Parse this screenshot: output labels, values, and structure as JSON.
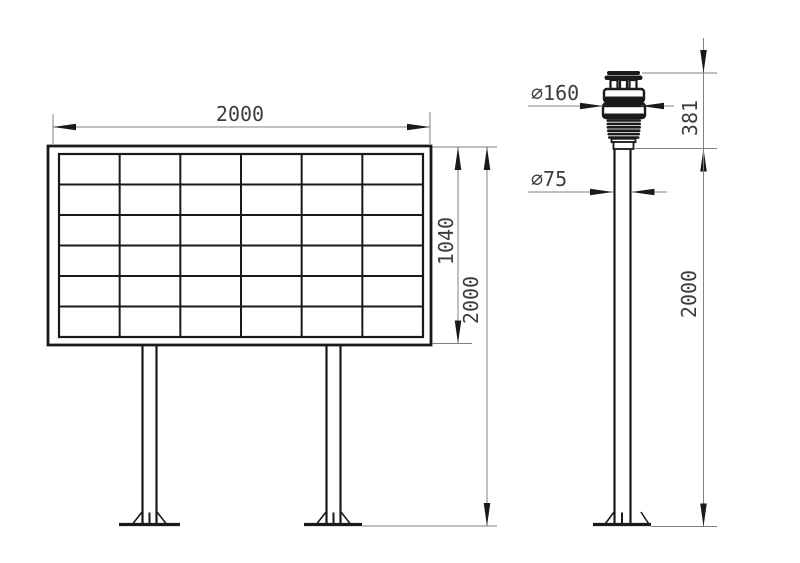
{
  "drawing": {
    "colors": {
      "background": "#ffffff",
      "object_line": "#1a1a1a",
      "dimension_line": "#818181",
      "text": "#3d3d3d"
    },
    "board": {
      "grid_columns": 6,
      "grid_rows": 6,
      "dim_width": "2000",
      "dim_panel_height": "1040",
      "dim_total_height": "2000"
    },
    "sensor": {
      "dim_head_diameter": "∅160",
      "dim_pole_diameter": "∅75",
      "dim_head_height": "381",
      "dim_pole_height": "2000"
    }
  }
}
